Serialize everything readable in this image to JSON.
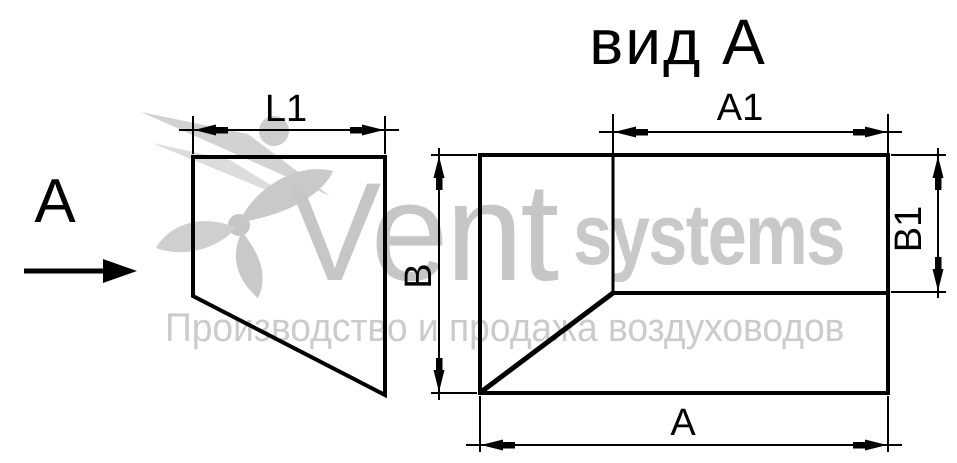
{
  "page": {
    "background_color": "#ffffff",
    "line_color": "#000000",
    "watermark_color": "#c8c8c8"
  },
  "view_title": "вид А",
  "view_direction": {
    "label": "А"
  },
  "side_view": {
    "length_dim_label": "L1"
  },
  "front_view": {
    "top_dim_label": "А1",
    "left_dim_label": "В",
    "right_dim_label": "В1",
    "bottom_dim_label": "А"
  },
  "watermark": {
    "brand": "Vent",
    "brand_suffix": "systems",
    "tagline": "Производство и продажа воздуховодов"
  }
}
